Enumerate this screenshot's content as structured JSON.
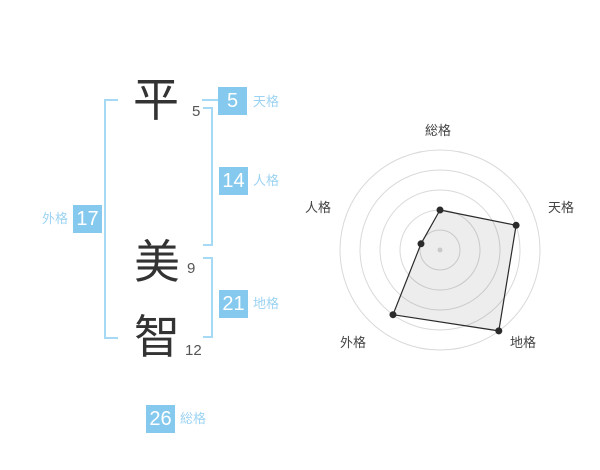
{
  "name_panel": {
    "characters": [
      {
        "char": "平",
        "strokes": "5"
      },
      {
        "char": "美",
        "strokes": "9"
      },
      {
        "char": "智",
        "strokes": "12"
      }
    ],
    "values": {
      "tenkaku": {
        "value": "5",
        "label": "天格"
      },
      "jinkaku": {
        "value": "14",
        "label": "人格"
      },
      "chikaku": {
        "value": "21",
        "label": "地格"
      },
      "gaikaku": {
        "value": "17",
        "label": "外格"
      },
      "soukaku": {
        "value": "26",
        "label": "総格"
      }
    },
    "colors": {
      "box_bg": "#85caee",
      "label_text": "#9cd3f3",
      "bracket": "#a6d9f4"
    }
  },
  "chart_data": {
    "type": "radar",
    "title": "",
    "axes": [
      {
        "label": "総格",
        "angle_deg": -90,
        "value": 2
      },
      {
        "label": "天格",
        "angle_deg": -18,
        "value": 4
      },
      {
        "label": "地格",
        "angle_deg": 54,
        "value": 5
      },
      {
        "label": "外格",
        "angle_deg": 126,
        "value": 4
      },
      {
        "label": "人格",
        "angle_deg": 198,
        "value": 1
      }
    ],
    "max_value": 5,
    "rings": 5,
    "unit_radius_px": 20,
    "center_px": [
      150,
      150
    ],
    "grid": "circular",
    "legend": "none",
    "ring_color": "#d9d9d9",
    "polygon_stroke": "#2b2b2b",
    "polygon_fill": "rgba(0,0,0,0.07)",
    "point_color": "#2b2b2b",
    "center_dot_color": "#c9c9c9"
  }
}
